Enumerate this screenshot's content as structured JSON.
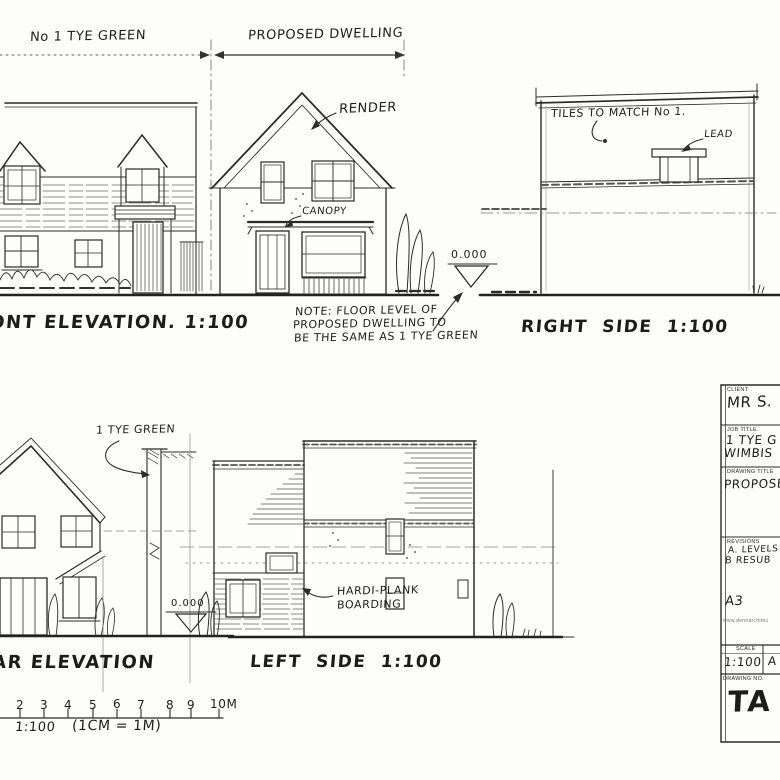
{
  "drawing": {
    "top_dimension": {
      "left_label": "No 1 TYE GREEN",
      "right_label": "PROPOSED DWELLING"
    },
    "front_elevation": {
      "caption": "FRONT ELEVATION. 1:100",
      "render_label": "RENDER",
      "canopy_label": "CANOPY",
      "level_marker": "0.000",
      "note_lines": [
        "NOTE: FLOOR LEVEL OF",
        "PROPOSED DWELLING TO",
        "BE THE SAME AS 1 TYE GREEN"
      ]
    },
    "right_side_elevation": {
      "caption": "RIGHT SIDE 1:100",
      "tiles_label": "TILES TO MATCH No 1.",
      "lead_label": "LEAD"
    },
    "rear_elevation": {
      "caption": "REAR ELEVATION",
      "tye_green_label": "1 TYE GREEN",
      "level_marker": "0.000"
    },
    "left_side_elevation": {
      "caption": "LEFT SIDE 1:100",
      "boarding_label_line1": "HARDI-PLANK",
      "boarding_label_line2": "BOARDING"
    },
    "scale_bar": {
      "numbers": [
        "2",
        "3",
        "4",
        "5",
        "6",
        "7",
        "8",
        "9",
        "10M"
      ],
      "scale": "1:100",
      "equivalence": "(1CM = 1M)"
    }
  },
  "title_block": {
    "client": {
      "header": "CLIENT",
      "value": "MR S."
    },
    "job_title": {
      "header": "JOB TITLE",
      "line1": "1 TYE G",
      "line2": "WIMBIS"
    },
    "drawing_title": {
      "header": "DRAWING TITLE",
      "value": "PROPOSE"
    },
    "revisions": {
      "header": "REVISIONS",
      "line1": "A. LEVELS",
      "line2": "B RESUB"
    },
    "paper_size": "A3",
    "website": "www.dennarchitec",
    "scale": {
      "header": "SCALE",
      "value": "1:100",
      "second_value": "A"
    },
    "drawing_no": {
      "header": "DRAWING NO.",
      "value": "TA 6"
    }
  },
  "colors": {
    "ink": "#2b2b2b",
    "paper": "#fdfdfc"
  }
}
